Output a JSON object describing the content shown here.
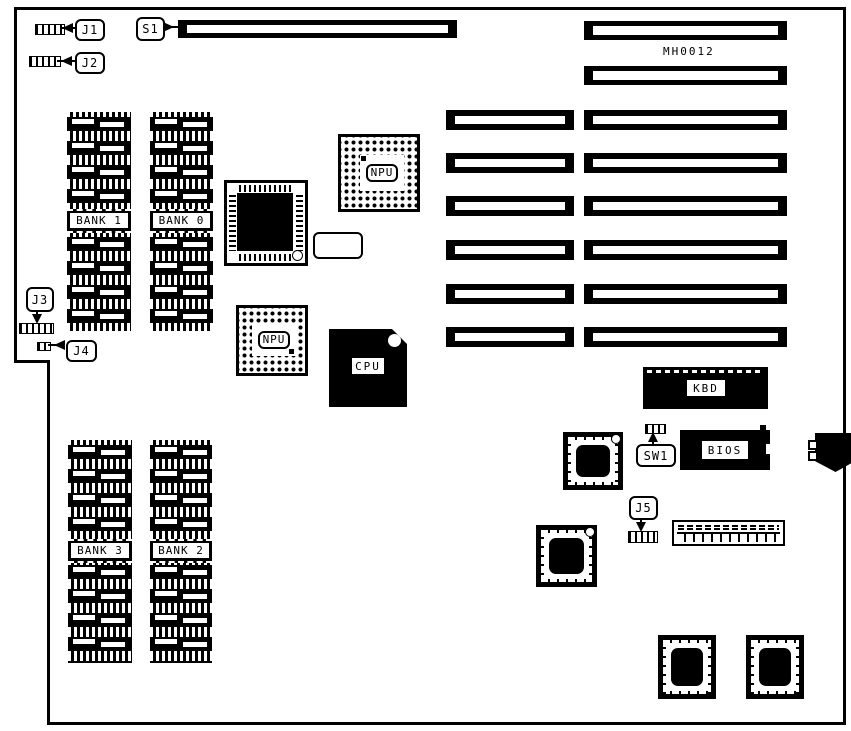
{
  "board": {
    "part_number": "MH0012",
    "callouts": {
      "j1": "J1",
      "j2": "J2",
      "j3": "J3",
      "j4": "J4",
      "j5": "J5",
      "s1": "S1",
      "sw1": "SW1"
    },
    "chips": {
      "npu_upper": "NPU",
      "npu_lower": "NPU",
      "cpu": "CPU",
      "keyboard": "KBD",
      "bios": "BIOS"
    },
    "memory_banks": {
      "bank0": "BANK 0",
      "bank1": "BANK 1",
      "bank2": "BANK 2",
      "bank3": "BANK 3"
    }
  }
}
